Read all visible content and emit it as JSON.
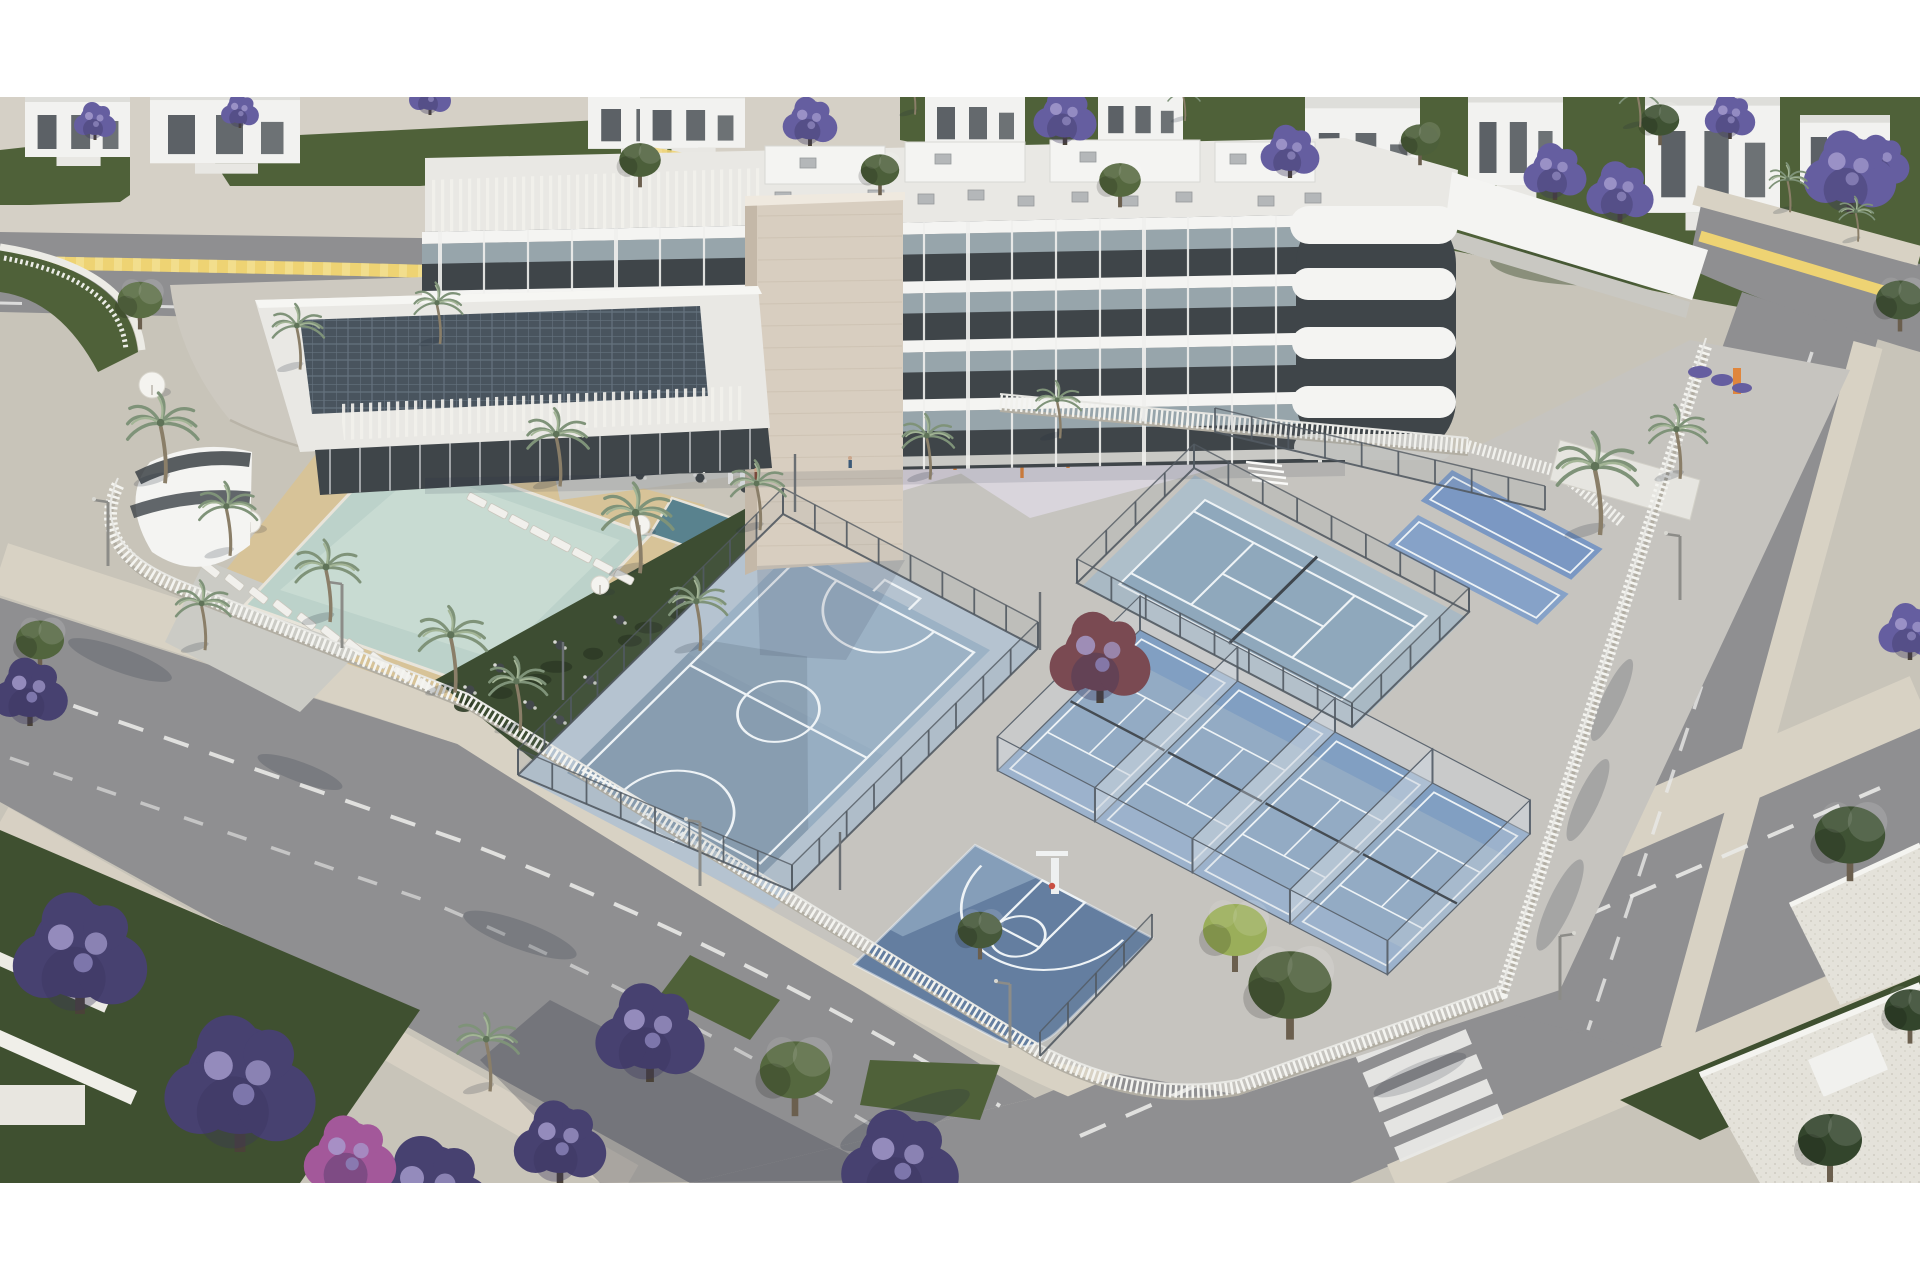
{
  "image": {
    "kind": "3d-architectural-aerial-render",
    "subject": "modern white residential complex with sports courts, pool and jacaranda-lined streets",
    "letterbox": {
      "top_px": 97,
      "bottom_px": 97,
      "color": "#ffffff"
    }
  },
  "scene": {
    "building": {
      "floors_visible": 4,
      "style": "white streamline balconies, dark recessed glazing, beige stone stair tower, rooftop solar panels"
    },
    "amenities": [
      "swimming-pool",
      "kids-plunge-pool",
      "sun-loungers",
      "parasols",
      "garden-dining-terrace",
      "playground",
      "calisthenics-area",
      "futsal-court",
      "basketball-half-court",
      "tennis-court",
      "padel-courts",
      "mini-courts"
    ],
    "vegetation": [
      "jacaranda-trees",
      "palm-trees",
      "green-trees",
      "lime-tree",
      "pink-flowering-tree",
      "lawns"
    ],
    "streets": [
      "top-street-with-yellow-line",
      "left-avenue",
      "bottom-avenue",
      "right-street",
      "pedestrian-crossing",
      "white-picket-perimeter-fence",
      "street-lamps"
    ]
  },
  "colors": {
    "white": "#ffffff",
    "pav": "#c8c4b9",
    "pavLight": "#d5d0c6",
    "plaza": "#cdc9c0",
    "drive": "#a9a8a4",
    "road": "#8f8f91",
    "roadMark": "#e9e9e7",
    "yellow": "#eed373",
    "yellowLight": "#f6e7a2",
    "sidewalk": "#d8d2c4",
    "lawn": "#4f6139",
    "lawnDark": "#3f5030",
    "grassLite": "#5a6c42",
    "houseWhite": "#f2f2f0",
    "houseFace": "#dededa",
    "houseDark": "#4b5156",
    "bldgWhite": "#f4f4f2",
    "bldgShade": "#dcdcd8",
    "bldgDark": "#3f4549",
    "glass": "#31383d",
    "balcony": "#b6c5cc",
    "towerA": "#d8cec0",
    "towerB": "#c4b8a8",
    "roofA": "#e9e8e4",
    "roofB": "#d9d8d5",
    "ac": "#b4b7b9",
    "solar": "#49545e",
    "solarLine": "#65727e",
    "slat": "#f2f1ec",
    "poolWater": "#bcd2ca",
    "poolLight": "#d2e1d9",
    "plunge": "#59828e",
    "sand": "#d7c398",
    "pebble": "#cbcbc5",
    "garden": "#3d4d32",
    "hedge": "#2e3b26",
    "table": "#43484b",
    "lounger": "#f1f0ec",
    "courtFutsal": "#97aec2",
    "courtApron": "#b5c3d0",
    "courtLine": "#eef3f6",
    "courtBasket": "#647ea0",
    "courtBasketLight": "#8ba3bd",
    "courtTennis": "#8fa8bc",
    "tennisApron": "#aebfca",
    "paddleFloor": "#93abc4",
    "paddleBlue": "#7e9cc2",
    "glassWall": "#cdd8e0",
    "glassFrame": "#5d6670",
    "meshFence": "#525a62",
    "picket": "#f4f4f0",
    "picketBase": "#b2aea3",
    "playPave": "#ddd7dd",
    "calPave": "#d9d5dc",
    "slideYellow": "#e8c93e",
    "orange": "#e0863c",
    "red": "#c94f42",
    "jac": "#655ea0",
    "jacDeep": "#474170",
    "jacDark": "#38335c",
    "jacLight": "#a79ed0",
    "pink": "#a3589a",
    "maroon": "#7a4a52",
    "green1": "#55683f",
    "green2": "#4a5c38",
    "greenDark": "#33452c",
    "lime": "#9aae5a",
    "palmFrond": "#7f9379",
    "palmFrondLight": "#a3b596",
    "palmTrunk": "#8a7e68",
    "shadow": "#252c3e",
    "gravelRoof": "#e4e2da"
  }
}
